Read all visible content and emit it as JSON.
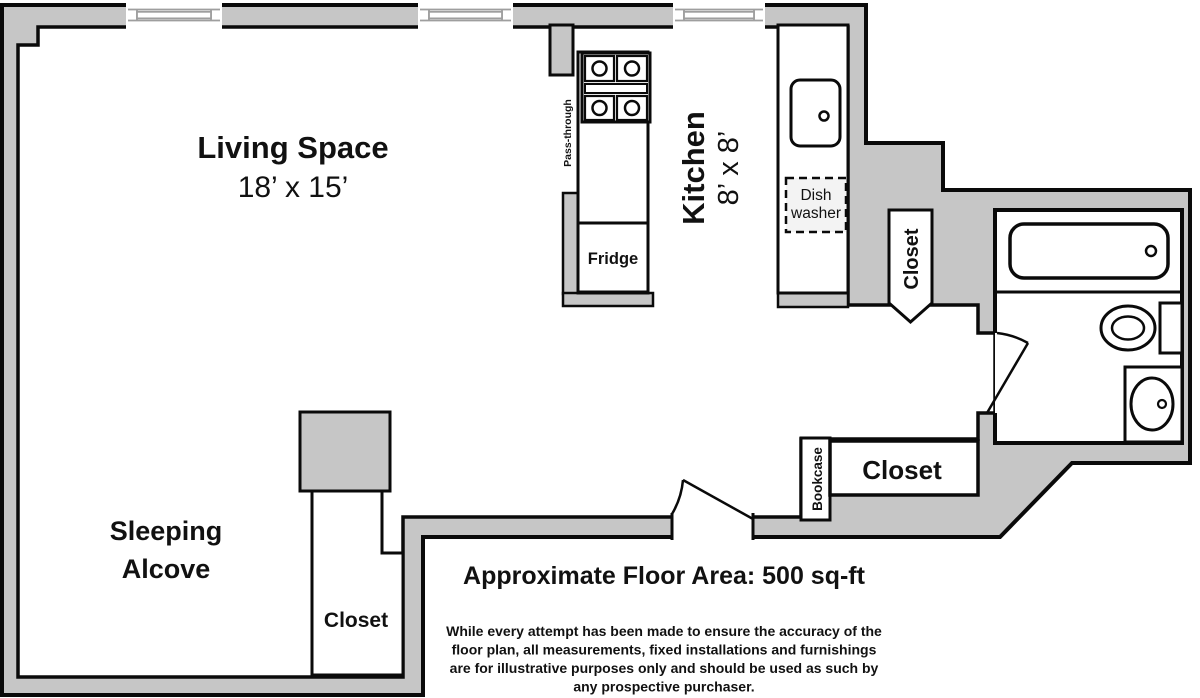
{
  "plan": {
    "rooms": {
      "living": {
        "title": "Living Space",
        "dims": "18’ x 15’"
      },
      "kitchen": {
        "title": "Kitchen",
        "dims": "8’ x 8’"
      },
      "sleeping": {
        "lines": [
          "Sleeping",
          "Alcove"
        ]
      }
    },
    "labels": {
      "pass_through": "Pass-through",
      "fridge": "Fridge",
      "dishwasher_lines": [
        "Dish",
        "washer"
      ],
      "closet_kitchen": "Closet",
      "closet_hall": "Closet",
      "closet_alcove": "Closet",
      "bookcase": "Bookcase"
    },
    "footer": {
      "area": "Approximate Floor Area: 500 sq-ft",
      "disclaimer_lines": [
        "While every attempt has been made to ensure the accuracy of the",
        "floor plan, all measurements, fixed installations and furnishings",
        "are for illustrative purposes only and should be used as such by",
        "any prospective purchaser."
      ]
    },
    "colors": {
      "wall": "#c6c6c6",
      "outline": "#0a0a0a",
      "window": "#9e9e9e",
      "floor": "#ffffff",
      "dw": "#f3f3f3",
      "ink": "#111111"
    }
  }
}
